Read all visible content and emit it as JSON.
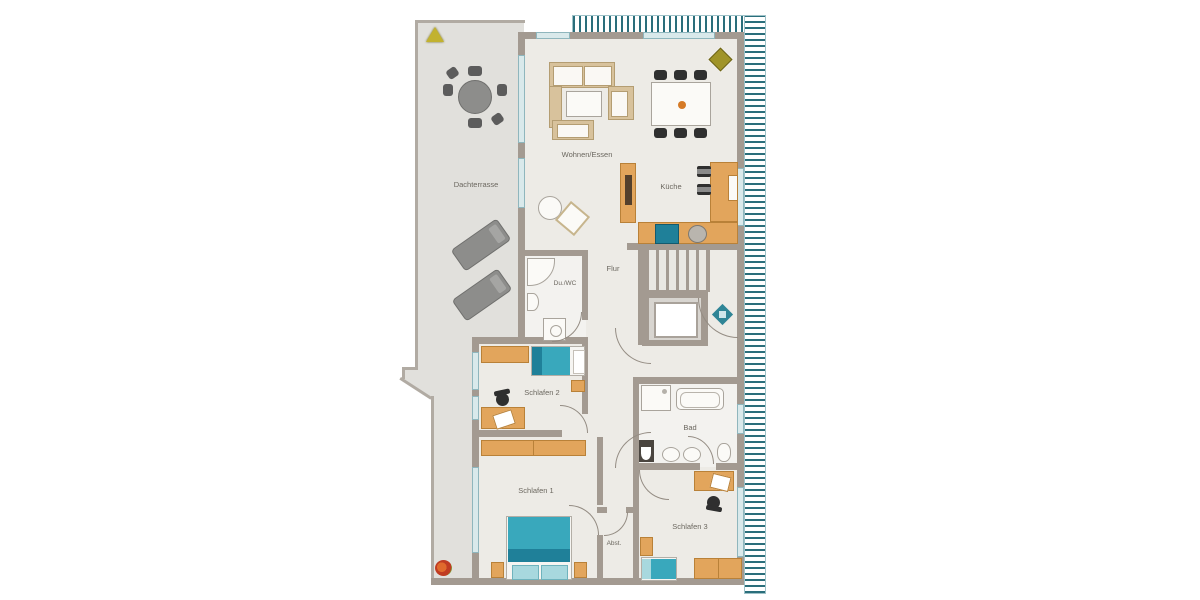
{
  "title": "Apartment floor plan (penthouse with roof terrace)",
  "rooms": {
    "dachterrasse": {
      "label": "Dachterrasse"
    },
    "wohnen_essen": {
      "label": "Wohnen/Essen"
    },
    "kueche": {
      "label": "Küche"
    },
    "flur": {
      "label": "Flur"
    },
    "du_wc": {
      "label": "Du./WC"
    },
    "schlafen1": {
      "label": "Schlafen 1"
    },
    "schlafen2": {
      "label": "Schlafen 2"
    },
    "schlafen3": {
      "label": "Schlafen 3"
    },
    "bad": {
      "label": "Bad"
    },
    "abst": {
      "label": "Abst."
    }
  },
  "icons": {
    "plant_top_left": "plant-triangle-icon",
    "plant_living": "plant-icon",
    "flower_bottom_left": "flower-icon",
    "entrance_marker": "entrance-diamond-icon"
  },
  "colors": {
    "wall": "#a39a91",
    "terrace_floor": "#e1e0dc",
    "apartment_floor": "#edebe6",
    "furniture_wood": "#e2a55c",
    "bed_teal": "#39a8bc",
    "hatch_teal": "#2a6e7b",
    "window": "#d9e9eb",
    "label_text": "#6b675f"
  }
}
